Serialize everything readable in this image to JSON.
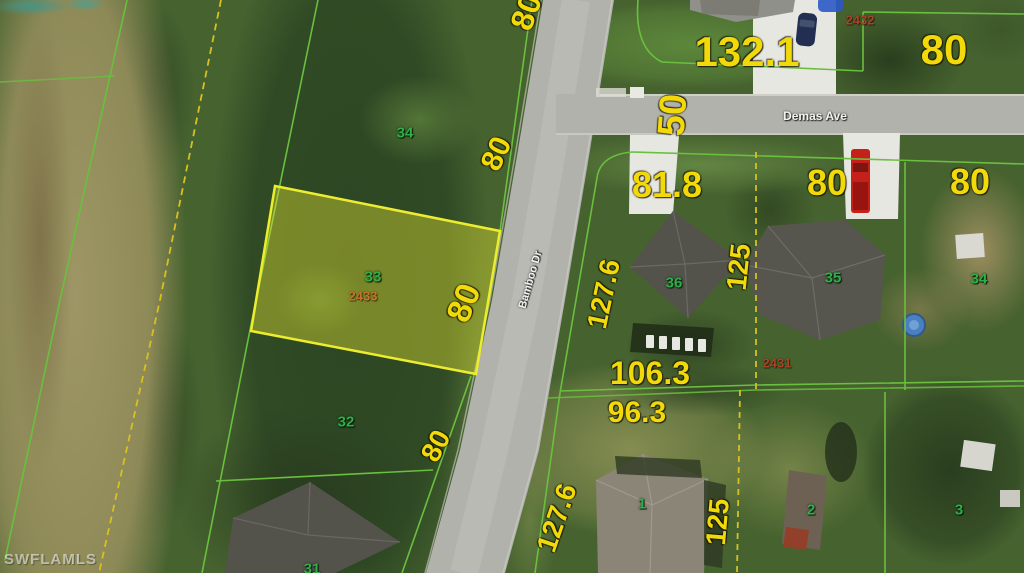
{
  "watermark": "SWFLAMLS",
  "streets": {
    "demas": "Demas Ave",
    "bamboo": "Bamboo Dr"
  },
  "dimensions": {
    "eighty_top": "80",
    "one32_1": "132.1",
    "eighty_2432": "80",
    "fifty": "50",
    "eighty_34w": "80",
    "eightyone_8": "81.8",
    "eighty_35": "80",
    "eighty_34e": "80",
    "one27_6_36": "127.6",
    "one25_36": "125",
    "eighty_33": "80",
    "one06_3": "106.3",
    "ninety6_3": "96.3",
    "one27_6_1": "127.6",
    "one25_1": "125",
    "eighty_32": "80"
  },
  "parcel_numbers": {
    "p34_west": "34",
    "p33": "33",
    "p32": "32",
    "p31": "31",
    "p36": "36",
    "p35": "35",
    "p34_east": "34",
    "p1": "1",
    "p2": "2",
    "p3": "3"
  },
  "parcel_ids": {
    "id2432": "2432",
    "id2433": "2433",
    "id2431": "2431"
  },
  "colors": {
    "dimension_text": "#f2d90a",
    "parcel_number_text": "#2fae4a",
    "parcel_id_text": "#a84426",
    "lot_line": "#6abf3f",
    "dashed_line": "#d8c020",
    "highlight_outline": "#eded2e",
    "highlight_fill": "rgba(225,225,50,0.42)",
    "road": "#b2b2ac",
    "street_text": "#f2f2ee",
    "watermark_text": "rgba(255,255,255,0.55)"
  }
}
